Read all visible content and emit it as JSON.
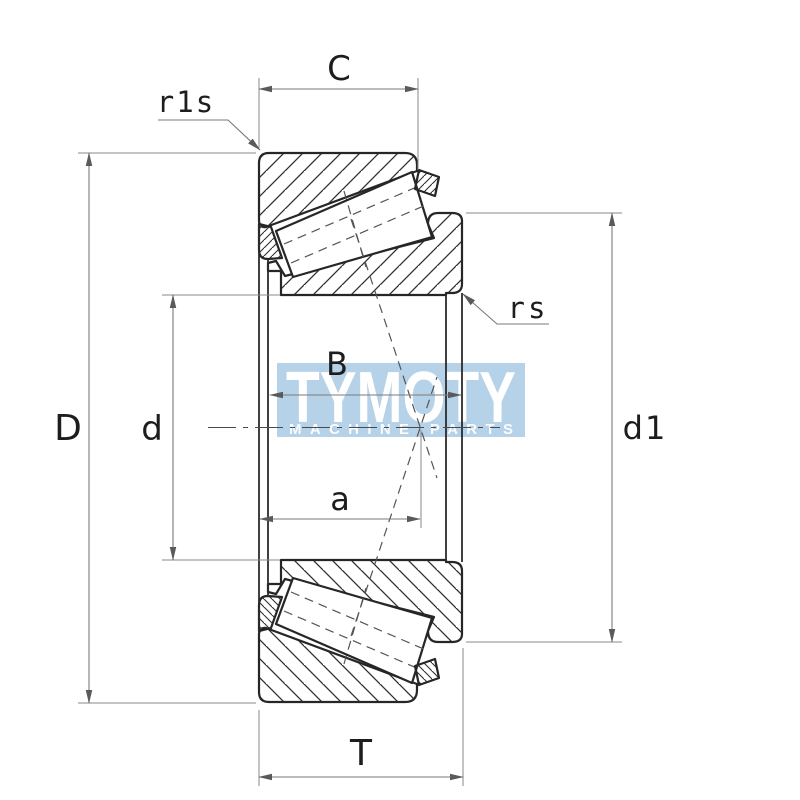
{
  "drawing": {
    "type": "tapered-roller-bearing-cross-section",
    "dimensions": {
      "outer_ring_width": "C",
      "outer_ring_corner_radius": "r1s",
      "inner_ring_corner_radius": "rs",
      "outer_diameter": "D",
      "bore_diameter": "d",
      "inner_ring_width": "B",
      "load_center_distance": "a",
      "rib_diameter": "d1",
      "total_width": "T"
    },
    "watermark": {
      "title": "TYMOTY",
      "subtitle": "MACHINE PARTS"
    },
    "colors": {
      "background": "#ffffff",
      "outline": "#262626",
      "dimension_lines": "#7a7a7a",
      "watermark_band": "#b6d2e8",
      "watermark_text": "#ffffff"
    }
  }
}
